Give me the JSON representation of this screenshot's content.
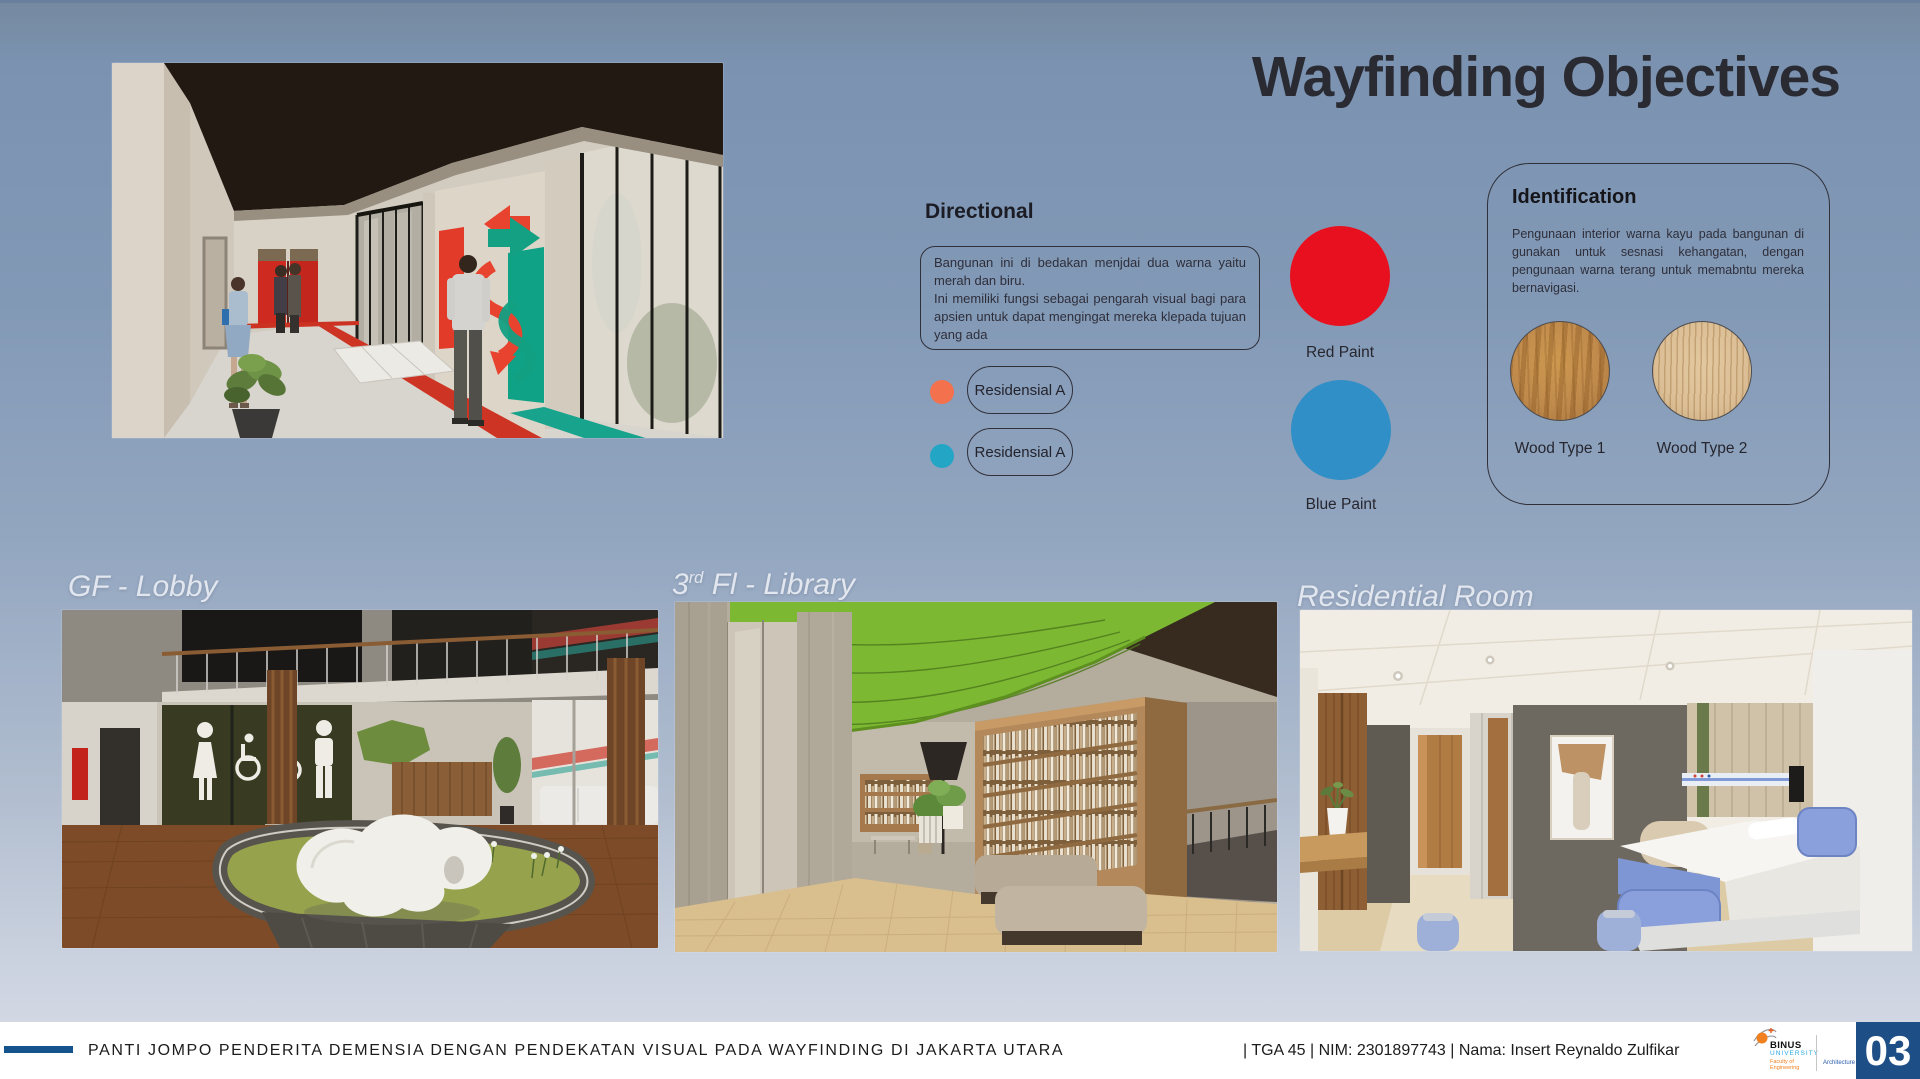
{
  "page": {
    "title": "Wayfinding Objectives"
  },
  "directional": {
    "heading": "Directional",
    "note_line1": "Bangunan ini di bedakan menjdai dua warna yaitu merah dan biru.",
    "note_line2": "Ini memiliki fungsi sebagai pengarah visual bagi para apsien untuk dapat mengingat mereka klepada tujuan yang ada",
    "legend": [
      {
        "label": "Residensial A",
        "dot_color": "#f4714e"
      },
      {
        "label": "Residensial A",
        "dot_color": "#23a5c6"
      }
    ]
  },
  "paints": [
    {
      "label": "Red Paint",
      "color": "#e8101e"
    },
    {
      "label": "Blue Paint",
      "color": "#2f8fc6"
    }
  ],
  "identification": {
    "heading": "Identification",
    "body": "Pengunaan interior warna kayu pada bangunan di gunakan untuk sesnasi kehangatan, dengan pengunaan warna terang untuk memabntu mereka bernavigasi.",
    "woods": [
      {
        "label": "Wood Type 1",
        "color": "#c08a4c"
      },
      {
        "label": "Wood Type 2",
        "color": "#dcbf96"
      }
    ]
  },
  "sections": {
    "lobby_label": "GF - Lobby",
    "library_label_prefix": "3",
    "library_label_sup": "rd",
    "library_label_rest": " Fl - Library",
    "residential_label": "Residential Room"
  },
  "footer": {
    "accent_color": "#15538c",
    "project_title": "PANTI JOMPO PENDERITA DEMENSIA DENGAN PENDEKATAN VISUAL PADA WAYFINDING DI JAKARTA UTARA",
    "meta": "| TGA 45 | NIM: 2301897743 | Nama: Insert Reynaldo Zulfikar",
    "logo": {
      "name": "BINUS",
      "university": "UNIVERSITY",
      "faculty_line1": "Faculty of",
      "faculty_line2": "Engineering",
      "department": "Architecture"
    },
    "page_number": "03",
    "page_badge_color": "#1d4f86"
  }
}
